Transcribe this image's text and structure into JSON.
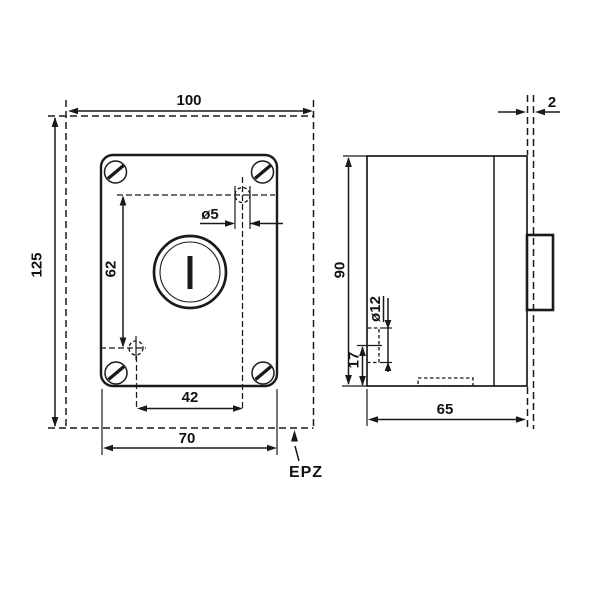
{
  "drawing": {
    "type": "technical-dimension-drawing",
    "background_color": "#ffffff",
    "line_color": "#1a1a1a",
    "front_view": {
      "overall_width_mm": "100",
      "overall_height_mm": "125",
      "vertical_hole_spacing_mm": "62",
      "small_hole_diameter": "ø5",
      "horizontal_hole_spacing_mm": "42",
      "faceplate_width_mm": "70",
      "mounting_plate_label": "EPZ"
    },
    "side_view": {
      "plate_thickness_mm": "2",
      "body_height_mm": "90",
      "entry_hole_diameter": "ø12",
      "entry_hole_offset_mm": "17",
      "body_depth_mm": "65"
    }
  }
}
